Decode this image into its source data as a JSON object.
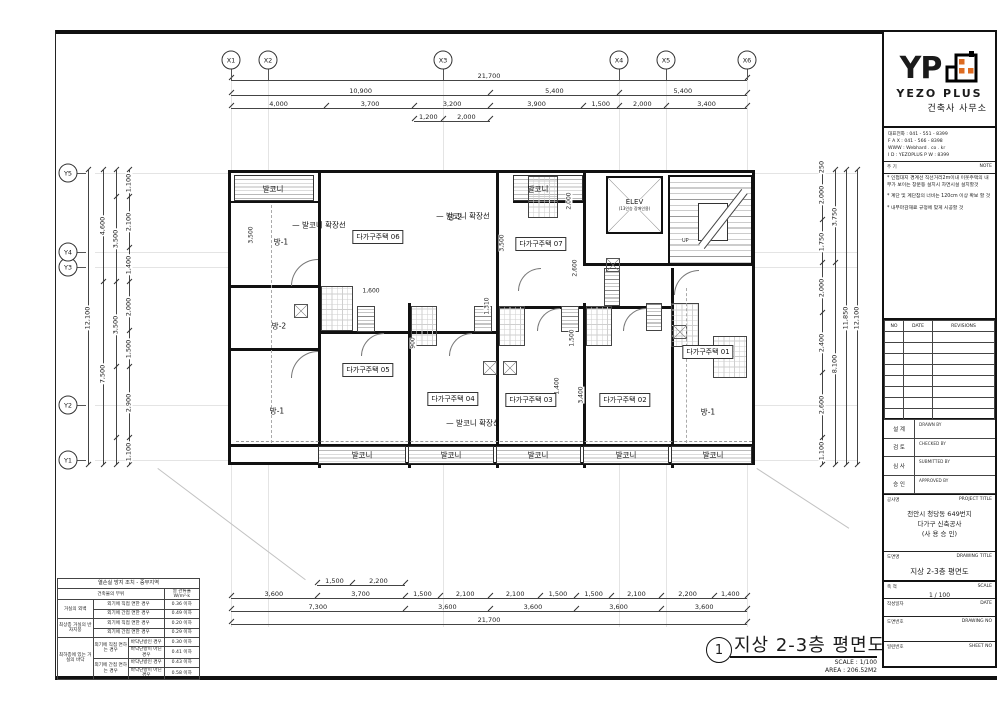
{
  "colors": {
    "line": "#111111",
    "accent_orange": "#dd6b21"
  },
  "titleblock": {
    "logo": {
      "yp": "YP",
      "name": "YEZO PLUS",
      "sub": "건축사 사무소"
    },
    "contact": [
      "대표전화 : 041 - 551 - 8399",
      "F A X : 041 - 566 - 8398",
      "WWW : Webhard . co . kr",
      "I D : YEZOPLUS   P W : 8399"
    ],
    "note": {
      "label_ko": "주 기",
      "label_en": "NOTE",
      "items": [
        "인접대지 경계선 직선거리2m이내 이웃주택의 내부가 보이는 창문등 설치시 차면시설 설치할것",
        "계단 및 계단참의 너비는 120cm 이상 확보 할 것",
        "내부마감재료 규정에 맞게 시공할 것"
      ]
    },
    "revisions": {
      "headers": [
        "NO",
        "DATE",
        "REVISIONS"
      ],
      "empty_rows": 8
    },
    "signoff": [
      {
        "ko": "설 계",
        "en": "DRAWN BY"
      },
      {
        "ko": "검 토",
        "en": "CHECKED BY"
      },
      {
        "ko": "심 사",
        "en": "SUBMITTED BY"
      },
      {
        "ko": "승 인",
        "en": "APPROVED BY"
      }
    ],
    "project": {
      "label_ko": "공사명",
      "label_en": "PROJECT TITLE",
      "lines": [
        "천안시 청당동 649번지",
        "다가구 신축공사",
        "(사 용 승 인)"
      ]
    },
    "drawing": {
      "label_ko": "도면명",
      "label_en": "DRAWING TITLE",
      "title": "지상 2-3층 평면도"
    },
    "scale": {
      "label_ko": "축 척",
      "label_en": "SCALE",
      "value": "1 / 100"
    },
    "date": {
      "label_ko": "작성일자",
      "label_en": "DATE",
      "value": ""
    },
    "drawing_no": {
      "label_ko": "도면번호",
      "label_en": "DRAWING NO",
      "value": ""
    },
    "sheet_no": {
      "label_ko": "일련번호",
      "label_en": "SHEET NO",
      "value": ""
    }
  },
  "thermal": {
    "title": "열손실 방지 조치 - 중부지역",
    "col_part": "건축물의 부위",
    "col_u": "열 관류율",
    "col_u_unit": "W/m²·k",
    "rows": [
      {
        "part": "거실의 외벽",
        "cond": "외기에 직접 면한 경우",
        "val": "0.36 이하"
      },
      {
        "cond": "외기에 간접 면한 경우",
        "val": "0.49 이하"
      },
      {
        "part": "최상층 거실의 반자지붕",
        "cond": "외기에 직접 면한 경우",
        "val": "0.20 이하"
      },
      {
        "cond": "외기에 간접 면한 경우",
        "val": "0.29 이하"
      },
      {
        "part": "최하층에 있는 거실의 바닥",
        "cond": "외기에 직접 면하는 경우",
        "sub": "바닥난방인 경우",
        "val": "0.30 이하"
      },
      {
        "sub": "바닥난방이 아닌 경우",
        "val": "0.41 이하"
      },
      {
        "cond": "외기에 간접 면하는 경우",
        "sub": "바닥난방인 경우",
        "val": "0.43 이하"
      },
      {
        "sub": "바닥난방이 아닌 경우",
        "val": "0.58 이하"
      }
    ]
  },
  "footer_title": {
    "num": "1",
    "title": "지상 2-3층 평면도",
    "scale": "SCALE : 1/100",
    "area": "AREA : 206.52M2"
  },
  "plan": {
    "grid_x": [
      "X1",
      "X2",
      "X3",
      "X4",
      "X5",
      "X6"
    ],
    "grid_y": [
      "Y1",
      "Y2",
      "Y3",
      "Y4",
      "Y5"
    ],
    "elevator": {
      "label": "ELEV",
      "sub": "(13인승 장애인용)"
    },
    "stair_up": "UP",
    "chains": [
      {
        "id": "t1",
        "labels": [
          "21,700"
        ],
        "weights": [
          21700
        ]
      },
      {
        "id": "t2",
        "labels": [
          "10,900",
          "5,400",
          "5,400"
        ],
        "weights": [
          10900,
          5400,
          5400
        ]
      },
      {
        "id": "t3",
        "labels": [
          "4,000",
          "3,700",
          "3,200",
          "3,900",
          "1,500",
          "2,000",
          "3,400"
        ],
        "weights": [
          4000,
          3700,
          3200,
          3900,
          1500,
          2000,
          3400
        ]
      },
      {
        "id": "t4",
        "labels": [
          "1,200",
          "2,000"
        ],
        "weights": [
          1200,
          2000
        ]
      },
      {
        "id": "b1",
        "labels": [
          "1,500",
          "2,200"
        ],
        "weights": [
          1500,
          2200
        ]
      },
      {
        "id": "b2",
        "labels": [
          "3,600",
          "3,700",
          "1,500",
          "2,100",
          "2,100",
          "1,500",
          "1,500",
          "2,100",
          "2,200",
          "1,400"
        ],
        "weights": [
          3600,
          3700,
          1500,
          2100,
          2100,
          1500,
          1500,
          2100,
          2200,
          1400
        ]
      },
      {
        "id": "b3",
        "labels": [
          "7,300",
          "3,600",
          "3,600",
          "3,600",
          "3,600"
        ],
        "weights": [
          7300,
          3600,
          3600,
          3600,
          3600
        ]
      },
      {
        "id": "b4",
        "labels": [
          "21,700"
        ],
        "weights": [
          21700
        ]
      },
      {
        "id": "l1",
        "labels": [
          "12,100"
        ],
        "weights": [
          12100
        ]
      },
      {
        "id": "l2",
        "labels": [
          "4,600",
          "7,500"
        ],
        "weights": [
          4600,
          7500
        ]
      },
      {
        "id": "l3",
        "labels": [
          "",
          "3,500",
          "3,500",
          "",
          ""
        ],
        "weights": [
          1100,
          3500,
          3500,
          2900,
          1100
        ]
      },
      {
        "id": "l4",
        "labels": [
          "1,100",
          "2,100",
          "1,400",
          "2,000",
          "1,500",
          "2,900",
          "1,100"
        ],
        "weights": [
          1100,
          2100,
          1400,
          2000,
          1500,
          2900,
          1100
        ]
      },
      {
        "id": "r1",
        "labels": [
          "250",
          "2,000",
          "1,750",
          "2,000",
          "2,400",
          "2,600",
          "1,100"
        ],
        "weights": [
          250,
          2000,
          1750,
          2000,
          2400,
          2600,
          1100
        ]
      },
      {
        "id": "r2",
        "labels": [
          "3,750",
          "8,100"
        ],
        "weights": [
          3750,
          8100
        ]
      },
      {
        "id": "r3",
        "labels": [
          "11,850"
        ],
        "weights": [
          11850
        ]
      },
      {
        "id": "r4",
        "labels": [
          "12,100"
        ],
        "weights": [
          12100
        ]
      }
    ],
    "rooms": [
      {
        "t": "발코니",
        "x": 42,
        "y": 16
      },
      {
        "t": "발코니",
        "x": 307,
        "y": 16
      },
      {
        "t": "발코니 확장선",
        "x": 88,
        "y": 52,
        "leader": true
      },
      {
        "t": "발코니 확장선",
        "x": 232,
        "y": 43,
        "leader": true
      },
      {
        "t": "발코니 확장선",
        "x": 242,
        "y": 250,
        "leader": true
      },
      {
        "t": "방-1",
        "x": 50,
        "y": 69
      },
      {
        "t": "방-2",
        "x": 224,
        "y": 44
      },
      {
        "t": "방-2",
        "x": 48,
        "y": 153
      },
      {
        "t": "방-1",
        "x": 46,
        "y": 238
      },
      {
        "t": "방-1",
        "x": 477,
        "y": 239
      },
      {
        "t": "다가구주택 06",
        "x": 147,
        "y": 64,
        "boxed": true
      },
      {
        "t": "다가구주택 07",
        "x": 310,
        "y": 71,
        "boxed": true
      },
      {
        "t": "다가구주택 05",
        "x": 137,
        "y": 197,
        "boxed": true
      },
      {
        "t": "다가구주택 04",
        "x": 222,
        "y": 226,
        "boxed": true
      },
      {
        "t": "다가구주택 03",
        "x": 300,
        "y": 227,
        "boxed": true
      },
      {
        "t": "다가구주택 02",
        "x": 394,
        "y": 227,
        "boxed": true
      },
      {
        "t": "다가구주택 01",
        "x": 477,
        "y": 179,
        "boxed": true
      },
      {
        "t": "발코니",
        "x": 131,
        "y": 282
      },
      {
        "t": "발코니",
        "x": 220,
        "y": 282
      },
      {
        "t": "발코니",
        "x": 307,
        "y": 282
      },
      {
        "t": "발코니",
        "x": 395,
        "y": 282
      },
      {
        "t": "발코니",
        "x": 482,
        "y": 282
      }
    ],
    "inline_dims": [
      {
        "t": "1,600",
        "x": 140,
        "y": 118
      },
      {
        "t": "2,000",
        "x": 338,
        "y": 28,
        "rot": true
      },
      {
        "t": "3,500",
        "x": 271,
        "y": 70,
        "rot": true
      },
      {
        "t": "3,500",
        "x": 20,
        "y": 62,
        "rot": true
      },
      {
        "t": "2,600",
        "x": 344,
        "y": 95,
        "rot": true
      },
      {
        "t": "1,310",
        "x": 256,
        "y": 133,
        "rot": true
      },
      {
        "t": "1,500",
        "x": 341,
        "y": 165,
        "rot": true
      },
      {
        "t": "1,400",
        "x": 326,
        "y": 213,
        "rot": true
      },
      {
        "t": "3,400",
        "x": 350,
        "y": 222,
        "rot": true
      },
      {
        "t": "900",
        "x": 182,
        "y": 170,
        "rot": true
      }
    ]
  }
}
